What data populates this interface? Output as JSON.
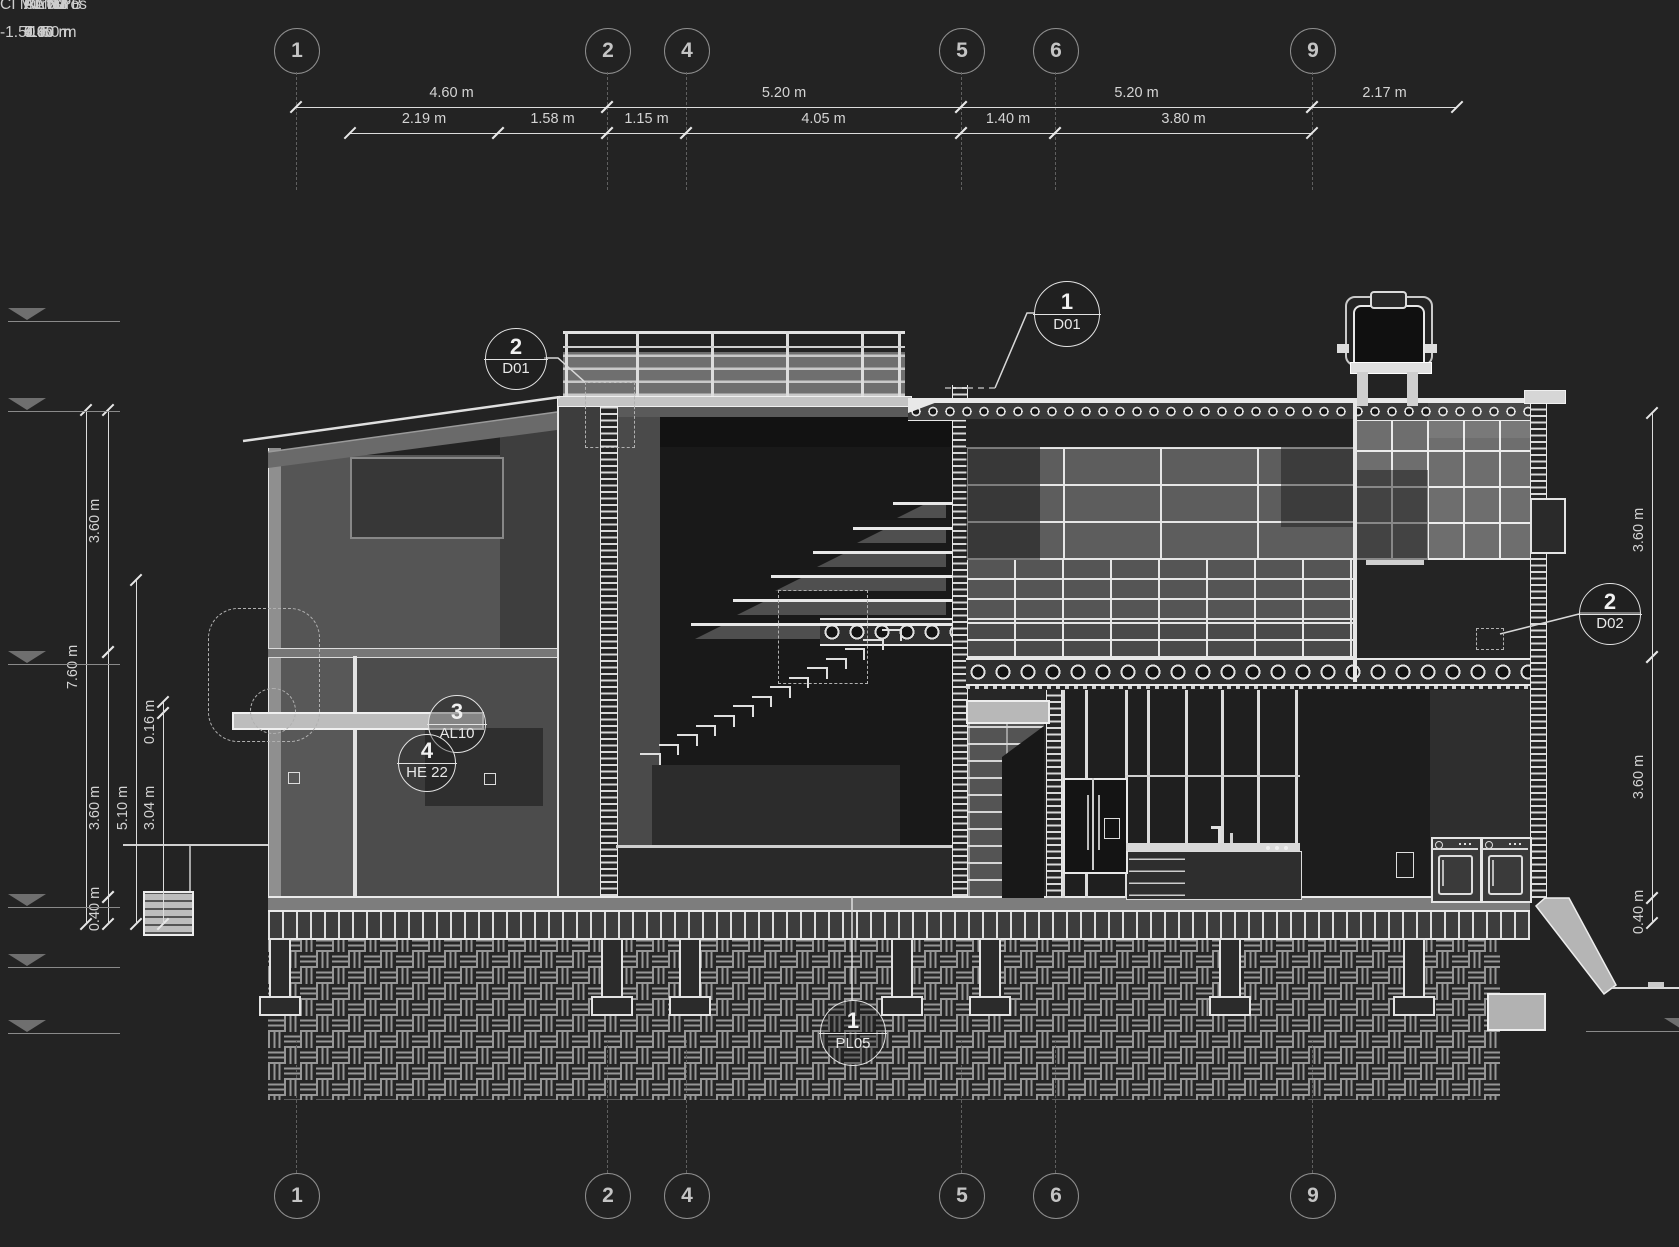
{
  "colors": {
    "background": "#232323",
    "line": "#e8e8e8",
    "dim_text": "#d4d4d4",
    "muted_line": "#8e8e8e",
    "wall_gray": "#555555",
    "dark_interior": "#191919"
  },
  "grid": {
    "labels": [
      "1",
      "2",
      "4",
      "5",
      "6",
      "9"
    ],
    "x": [
      296,
      607,
      686,
      961,
      1055,
      1312
    ]
  },
  "dims_top": {
    "row1": [
      {
        "label": "4.60 m",
        "x1": 296,
        "x2": 607
      },
      {
        "label": "5.20 m",
        "x1": 607,
        "x2": 961
      },
      {
        "label": "5.20 m",
        "x1": 961,
        "x2": 1312
      },
      {
        "label": "2.17 m",
        "x1": 1312,
        "x2": 1457
      }
    ],
    "row2": [
      {
        "label": "2.19 m",
        "x1": 350,
        "x2": 498
      },
      {
        "label": "1.58 m",
        "x1": 498,
        "x2": 607
      },
      {
        "label": "1.15 m",
        "x1": 607,
        "x2": 686
      },
      {
        "label": "4.05 m",
        "x1": 686,
        "x2": 961
      },
      {
        "label": "1.40 m",
        "x1": 961,
        "x2": 1055
      },
      {
        "label": "3.80 m",
        "x1": 1055,
        "x2": 1312
      }
    ]
  },
  "dims_left": [
    {
      "label": "7.60 m",
      "x": 86,
      "y1": 410,
      "y2": 924,
      "label_y": 667
    },
    {
      "label": "3.60 m",
      "x": 108,
      "y1": 410,
      "y2": 652,
      "label_y": 521
    },
    {
      "label": "3.60 m",
      "x": 108,
      "y1": 652,
      "y2": 897,
      "label_y": 808
    },
    {
      "label": "0.40 m",
      "x": 108,
      "y1": 897,
      "y2": 924,
      "label_y": 909
    },
    {
      "label": "5.10 m",
      "x": 136,
      "y1": 580,
      "y2": 924,
      "label_y": 808
    },
    {
      "label": "0.16 m",
      "x": 163,
      "y1": 702,
      "y2": 713,
      "label_y": 722
    },
    {
      "label": "3.04 m",
      "x": 163,
      "y1": 713,
      "y2": 924,
      "label_y": 808
    }
  ],
  "dims_right": [
    {
      "label": "3.60 m",
      "x": 1652,
      "y1": 413,
      "y2": 657,
      "label_y": 530
    },
    {
      "label": "3.60 m",
      "x": 1652,
      "y1": 657,
      "y2": 898,
      "label_y": 777
    },
    {
      "label": "0.40 m",
      "x": 1652,
      "y1": 898,
      "y2": 923,
      "label_y": 912
    }
  ],
  "levels": {
    "left": [
      {
        "name": "AA N4",
        "elev": "8.90 m",
        "y": 300
      },
      {
        "name": "AA N3",
        "elev": "7.60 m",
        "y": 390
      },
      {
        "name": "PL N2",
        "elev": "4.00 m",
        "y": 643
      },
      {
        "name": "PL N1",
        "elev": "0.40 m",
        "y": 886
      },
      {
        "name": "AA 0 PB",
        "elev": "0.00 m",
        "y": 946
      },
      {
        "name": "CI Muros",
        "elev": "-1.50 m",
        "y": 1012
      }
    ],
    "right": [
      {
        "name": "CI Muros",
        "elev": "-1.50 m",
        "y": 1010
      }
    ]
  },
  "callouts": [
    {
      "num": "2",
      "code": "D01",
      "cx": 515,
      "cy": 358,
      "r": 30
    },
    {
      "num": "1",
      "code": "D01",
      "cx": 1066,
      "cy": 313,
      "r": 32
    },
    {
      "num": "2",
      "code": "D02",
      "cx": 1609,
      "cy": 613,
      "r": 30
    },
    {
      "num": "3",
      "code": "AL10",
      "cx": 456,
      "cy": 723,
      "r": 28
    },
    {
      "num": "4",
      "code": "HE 22",
      "cx": 426,
      "cy": 762,
      "r": 28
    },
    {
      "num": "1",
      "code": "PL05",
      "cx": 852,
      "cy": 1032,
      "r": 32
    }
  ]
}
